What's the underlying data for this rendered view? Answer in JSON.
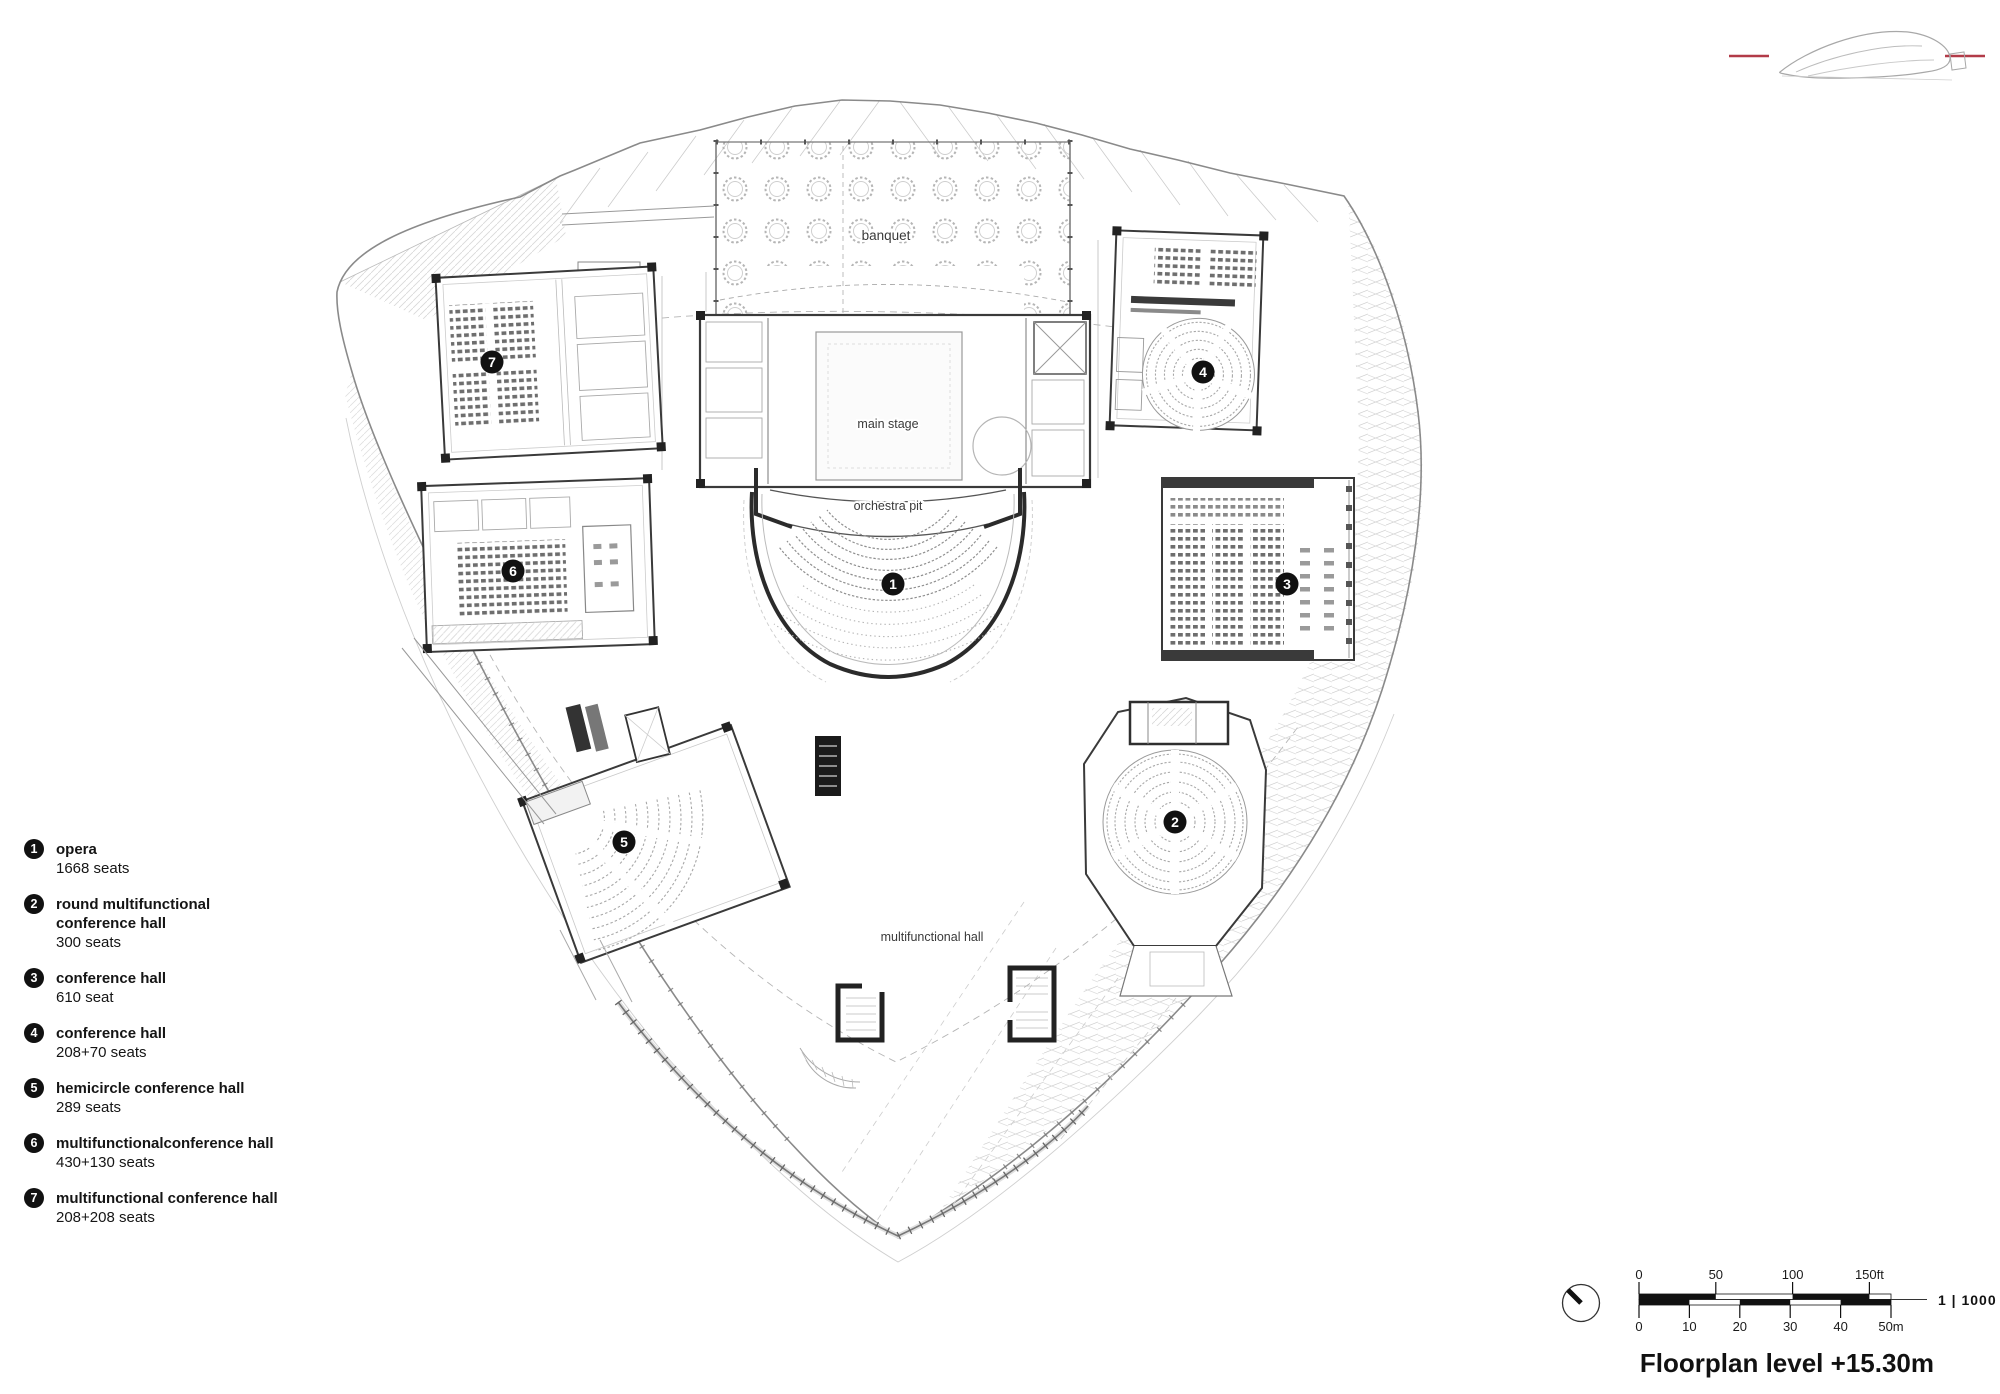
{
  "title": "Floorplan level +15.30m",
  "logo": {
    "icon": "building-elevation-icon",
    "accent_color": "#b23b48"
  },
  "plan": {
    "labels": {
      "banquet": "banquet",
      "main_stage": "main stage",
      "orchestra_pit": "orchestra pit",
      "multifunctional_hall": "multifunctional hall"
    },
    "badges": [
      "1",
      "2",
      "3",
      "4",
      "5",
      "6",
      "7"
    ]
  },
  "legend": {
    "items": [
      {
        "num": "1",
        "title": "opera",
        "seats": "1668 seats"
      },
      {
        "num": "2",
        "title": "round multifunctional\nconference hall",
        "seats": "300 seats"
      },
      {
        "num": "3",
        "title": "conference hall",
        "seats": "610 seat"
      },
      {
        "num": "4",
        "title": "conference hall",
        "seats": "208+70 seats"
      },
      {
        "num": "5",
        "title": "hemicircle conference hall",
        "seats": "289 seats"
      },
      {
        "num": "6",
        "title": "multifunctionalconference hall",
        "seats": "430+130 seats"
      },
      {
        "num": "7",
        "title": "multifunctional conference hall",
        "seats": "208+208 seats"
      }
    ]
  },
  "scalebar": {
    "ratio": "1 | 1000",
    "feet_ticks": [
      "0",
      "50",
      "100",
      "150ft"
    ],
    "meter_ticks": [
      "0",
      "10",
      "20",
      "30",
      "40",
      "50m"
    ]
  },
  "colors": {
    "accent_red": "#b23b48",
    "badge": "#111111",
    "wall_dark": "#2f2f2f",
    "line_light": "#c8c8c8"
  }
}
